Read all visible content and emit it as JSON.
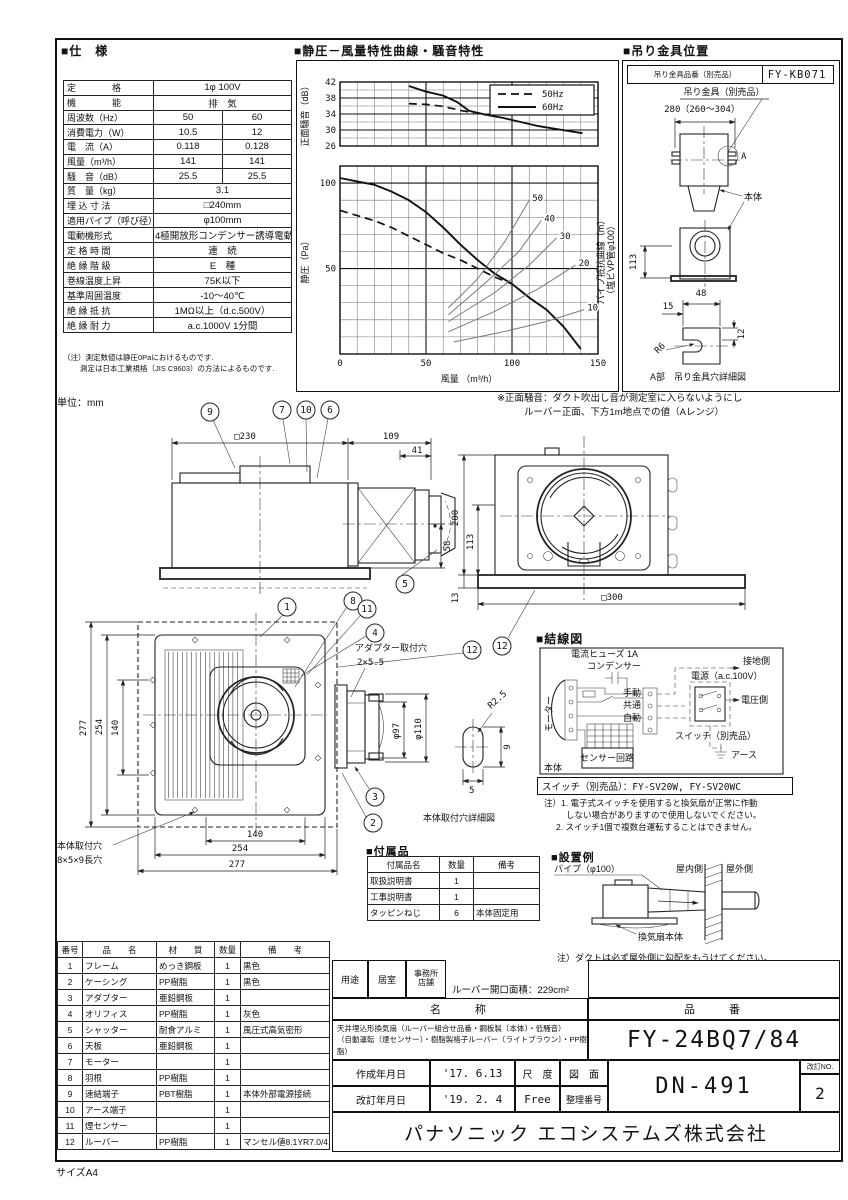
{
  "meta": {
    "sheet_size": "サイズA4",
    "unit": "単位：mm"
  },
  "balloons": {
    "n1": "1",
    "n2": "2",
    "n3": "3",
    "n4": "4",
    "n5": "5",
    "n6": "6",
    "n7": "7",
    "n8": "8",
    "n9": "9",
    "n10": "10",
    "n11": "11",
    "n12": "12"
  },
  "spec": {
    "heading": "■仕　様",
    "rows": [
      {
        "label": "定　　　　格",
        "value": "1φ 100V"
      },
      {
        "label": "機　　　　能",
        "value": "排　気"
      },
      {
        "label": "周波数（Hz）",
        "v50": "50",
        "v60": "60"
      },
      {
        "label": "消費電力（W）",
        "v50": "10.5",
        "v60": "12"
      },
      {
        "label": "電　流（A）",
        "v50": "0.118",
        "v60": "0.128"
      },
      {
        "label": "風量（m³/h）",
        "v50": "141",
        "v60": "141"
      },
      {
        "label": "騒　音（dB）",
        "v50": "25.5",
        "v60": "25.5"
      },
      {
        "label": "質　量（kg）",
        "value": "3.1"
      },
      {
        "label": "埋 込 寸 法",
        "value": "□240mm"
      },
      {
        "label": "適用パイプ（呼び径）",
        "value": "φ100mm"
      },
      {
        "label": "電動機形式",
        "value": "4極開放形コンデンサー誘導電動機"
      },
      {
        "label": "定 格 時 間",
        "value": "連　続"
      },
      {
        "label": "絶 縁 階 級",
        "value": "E　種"
      },
      {
        "label": "巻線温度上昇",
        "value": "75K以下"
      },
      {
        "label": "基準周囲温度",
        "value": "-10～40℃"
      },
      {
        "label": "絶 縁 抵 抗",
        "value": "1MΩ以上（d.c.500V）"
      },
      {
        "label": "絶 縁 耐 力",
        "value": "a.c.1000V 1分間"
      }
    ],
    "note1": "（注）測定数値は静圧0Paにおけるものです.",
    "note2": "測定は日本工業規格（JIS C9603）の方法によるものです."
  },
  "charts": {
    "heading": "■静圧－風量特性曲線・騒音特性",
    "note_line1": "※正面騒音：ダクト吹出し音が測定室に入らないようにし",
    "note_line2": "ルーバー正面、下方1m地点での値（Aレンジ）"
  },
  "chart_data": [
    {
      "type": "line",
      "title": "騒音特性（正面騒音）",
      "ylabel": "正面騒音（dB）",
      "xlim": [
        0,
        150
      ],
      "ylim": [
        26,
        42
      ],
      "grid_dx": 10,
      "grid_dy": 2,
      "xticks": [
        0,
        50,
        100,
        150
      ],
      "yticks": [
        26,
        30,
        34,
        38,
        42
      ],
      "legend": [
        {
          "label": "50Hz",
          "style": "dashed"
        },
        {
          "label": "60Hz",
          "style": "solid"
        }
      ],
      "series": [
        {
          "name": "60Hz",
          "style": "solid",
          "points": [
            [
              40,
              41
            ],
            [
              50,
              39.6
            ],
            [
              60,
              38.6
            ],
            [
              68,
              37
            ],
            [
              75,
              34.8
            ],
            [
              85,
              33.8
            ],
            [
              95,
              33
            ],
            [
              105,
              32
            ],
            [
              115,
              31
            ],
            [
              125,
              30.3
            ],
            [
              135,
              29.6
            ],
            [
              141,
              29.2
            ]
          ]
        },
        {
          "name": "50Hz",
          "style": "dashed",
          "points": [
            [
              40,
              36.6
            ],
            [
              50,
              36.4
            ],
            [
              60,
              35.9
            ],
            [
              70,
              34.9
            ],
            [
              78,
              34.3
            ]
          ]
        }
      ]
    },
    {
      "type": "line",
      "title": "静圧－風量特性曲線",
      "xlabel": "風量 （m³/h）",
      "ylabel": "静圧（Pa）",
      "right_label_1": "パイプ抵抗曲線（m）",
      "right_label_2": "（塩ビVP管φ100）",
      "xlim": [
        0,
        150
      ],
      "ylim": [
        0,
        110
      ],
      "grid_dx": 10,
      "grid_dy": 10,
      "xticks": [
        0,
        50,
        100,
        150
      ],
      "yticks": [
        0,
        50,
        100
      ],
      "ylabels": [
        50,
        100
      ],
      "series": [
        {
          "name": "60Hz",
          "style": "solid",
          "points": [
            [
              0,
              103
            ],
            [
              10,
              101
            ],
            [
              20,
              99
            ],
            [
              30,
              95
            ],
            [
              40,
              90
            ],
            [
              50,
              83
            ],
            [
              60,
              74
            ],
            [
              70,
              64
            ],
            [
              80,
              55
            ],
            [
              90,
              47
            ],
            [
              100,
              41
            ],
            [
              110,
              33
            ],
            [
              120,
              26
            ],
            [
              130,
              16
            ],
            [
              140,
              3
            ]
          ]
        },
        {
          "name": "50Hz",
          "style": "dashed",
          "points": [
            [
              0,
              84
            ],
            [
              10,
              81
            ],
            [
              20,
              78
            ],
            [
              30,
              74
            ],
            [
              40,
              69
            ],
            [
              50,
              64
            ],
            [
              60,
              59
            ],
            [
              70,
              55
            ],
            [
              80,
              50
            ],
            [
              90,
              45
            ],
            [
              100,
              41
            ],
            [
              110,
              33
            ],
            [
              120,
              26
            ],
            [
              130,
              16
            ],
            [
              140,
              3
            ]
          ]
        },
        {
          "name": "パイプ抵抗 50m",
          "style": "thin",
          "label": "50",
          "points": [
            [
              63,
              27
            ],
            [
              80,
              44
            ],
            [
              96,
              66
            ],
            [
              110,
              90
            ]
          ]
        },
        {
          "name": "パイプ抵抗 40m",
          "style": "thin",
          "label": "40",
          "points": [
            [
              63,
              23
            ],
            [
              85,
              42
            ],
            [
              104,
              60
            ],
            [
              117,
              78
            ]
          ]
        },
        {
          "name": "パイプ抵抗 30m",
          "style": "thin",
          "label": "30",
          "points": [
            [
              63,
              19
            ],
            [
              90,
              36
            ],
            [
              110,
              52
            ],
            [
              126,
              68
            ]
          ]
        },
        {
          "name": "パイプ抵抗 20m",
          "style": "thin",
          "label": "20",
          "points": [
            [
              63,
              13
            ],
            [
              90,
              25
            ],
            [
              115,
              38
            ],
            [
              137,
              52
            ]
          ]
        },
        {
          "name": "パイプ抵抗 10m",
          "style": "thin",
          "label": "10",
          "points": [
            [
              66,
              7
            ],
            [
              95,
              13
            ],
            [
              120,
              19
            ],
            [
              142,
              26
            ]
          ]
        }
      ]
    }
  ],
  "bracket": {
    "heading": "■吊り金具位置",
    "part_label": "吊り金具品番（別売品）",
    "part_no": "FY-KB071",
    "bracket_label": "吊り金具（別売品）",
    "dim_width": "280（260～304）",
    "label_a": "A",
    "body_label": "本体",
    "d113": "113",
    "d48": "48",
    "d15": "15",
    "d12": "12",
    "r6": "R6",
    "caption": "A部　吊り金具穴詳細図"
  },
  "drawings": {
    "side": {
      "d230": "□230",
      "d109": "109",
      "d41": "41",
      "d58": "58"
    },
    "back": {
      "d200": "200",
      "d113": "113",
      "d13": "13",
      "d300": "□300"
    },
    "bottom": {
      "d277": "277",
      "d254": "254",
      "d140": "140",
      "mount1": "本体取付穴",
      "mount2": "8×5×9長穴",
      "adapter1": "アダプター取付穴",
      "adapter2": "2×5.5",
      "d97": "φ97",
      "d110": "φ110",
      "r25": "R2.5",
      "d9": "9",
      "d5": "5",
      "caption": "本体取付穴詳細図"
    }
  },
  "wiring": {
    "heading": "■結線図",
    "fuse": "電流ヒューズ 1A",
    "capacitor": "コンデンサー",
    "motor": "モーター",
    "manual": "手動",
    "common": "共通",
    "auto": "自動",
    "ground_side": "接地側",
    "power": "電源（a.c.100V）",
    "voltage_side": "電圧側",
    "switch_label": "スイッチ（別売品）",
    "earth": "アース",
    "body": "本体",
    "sensor": "センサー回路",
    "switch_row": "スイッチ（別売品）：FY-SV20W, FY-SV20WC",
    "note1": "注）1. 電子式スイッチを使用すると換気扇が正常に作動",
    "note2": "しない場合がありますので使用しないでください。",
    "note3": "2. スイッチ1個で複数台運転することはできません。"
  },
  "accessories": {
    "heading": "■付属品",
    "headers": [
      "付属品名",
      "数量",
      "備考"
    ],
    "rows": [
      [
        "取扱説明書",
        "1",
        ""
      ],
      [
        "工事説明書",
        "1",
        ""
      ],
      [
        "タッピンねじ",
        "6",
        "本体固定用"
      ]
    ]
  },
  "install": {
    "heading": "■設置例",
    "pipe": "パイプ（φ100）",
    "indoor": "屋内側",
    "outdoor": "屋外側",
    "body": "換気扇本体",
    "note": "注）ダクトは必ず屋外側に勾配をもうけてください。"
  },
  "parts": {
    "headers": [
      "番号",
      "品　　名",
      "材　　質",
      "数量",
      "備　　考"
    ],
    "rows": [
      [
        "1",
        "フレーム",
        "めっき鋼板",
        "1",
        "黒色"
      ],
      [
        "2",
        "ケーシング",
        "PP樹脂",
        "1",
        "黒色"
      ],
      [
        "3",
        "アダプター",
        "亜鉛鋼板",
        "1",
        ""
      ],
      [
        "4",
        "オリフィス",
        "PP樹脂",
        "1",
        "灰色"
      ],
      [
        "5",
        "シャッター",
        "耐食アルミ",
        "1",
        "風圧式高気密形"
      ],
      [
        "6",
        "天板",
        "亜鉛鋼板",
        "1",
        ""
      ],
      [
        "7",
        "モーター",
        "",
        "1",
        ""
      ],
      [
        "8",
        "羽根",
        "PP樹脂",
        "1",
        ""
      ],
      [
        "9",
        "速結端子",
        "PBT樹脂",
        "1",
        "本体外部電源接続"
      ],
      [
        "10",
        "アース端子",
        "",
        "1",
        ""
      ],
      [
        "11",
        "煙センサー",
        "",
        "1",
        ""
      ],
      [
        "12",
        "ルーバー",
        "PP樹脂",
        "1",
        "マンセル値8.1YR7.0/4.0"
      ]
    ]
  },
  "title_block": {
    "usage_label": "用途",
    "usage1": "居室",
    "usage2a": "事務所",
    "usage2b": "店舗",
    "louver_area": "ルーバー開口面積：229cm²",
    "name_header": "名　　称",
    "model_header": "品　　番",
    "name_line1": "天井埋込形換気扇（ルーバー組合せ品番・鋼板製〔本体〕・低騒音）",
    "name_line2": "（自動運転〔煙センサー〕・樹脂製格子ルーバー〔ライトブラウン〕・PP樹脂）",
    "model": "FY-24BQ7/84",
    "created_label": "作成年月日",
    "created": "'17. 6.13",
    "revised_label": "改訂年月日",
    "revised": "'19. 2. 4",
    "scale_label": "尺　度",
    "scale": "Free",
    "drawing_label_a": "図　面",
    "drawing_label_b": "整理番号",
    "drawing_no": "DN-491",
    "rev_label": "改訂NO.",
    "rev_no": "2",
    "company": "パナソニック エコシステムズ株式会社"
  }
}
